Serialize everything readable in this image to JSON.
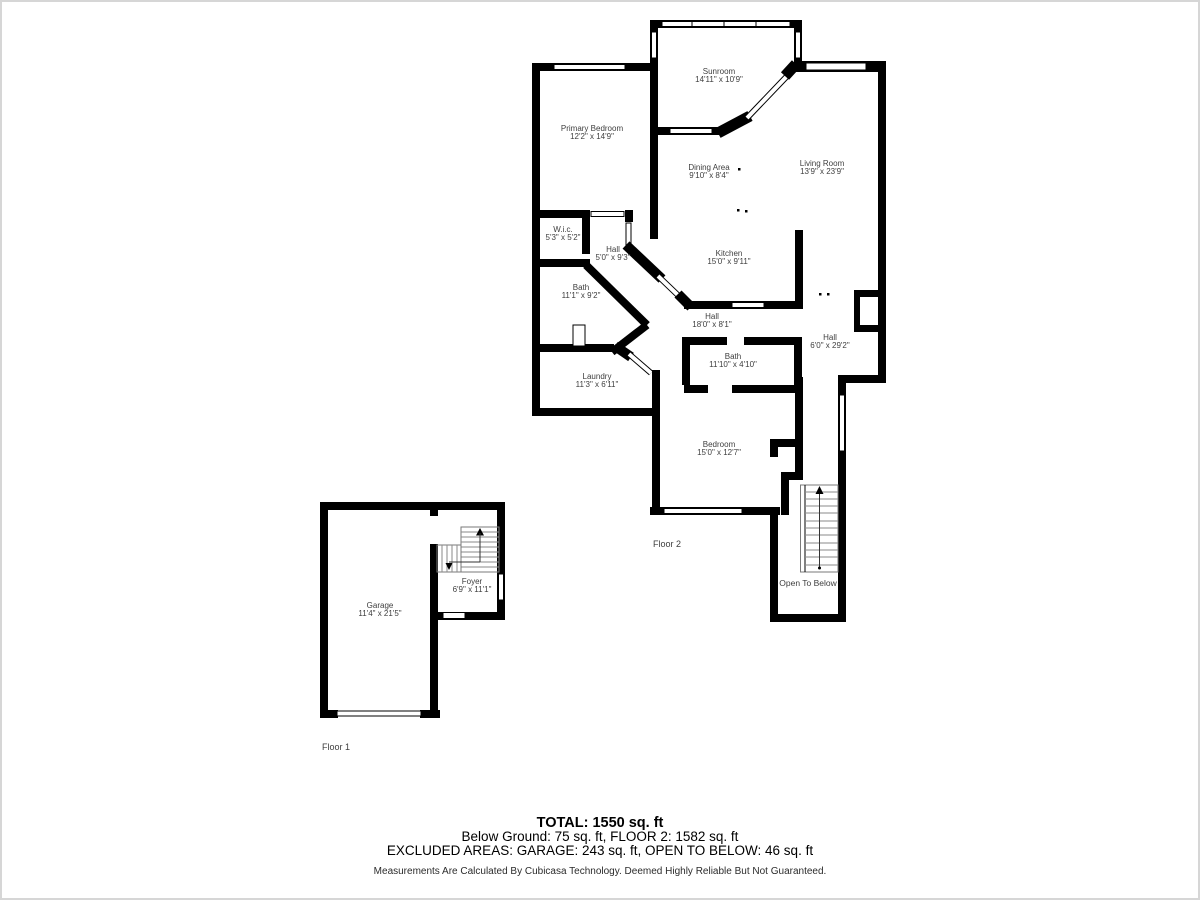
{
  "page": {
    "background": "#ffffff",
    "border_color": "#d6d6d6",
    "wall_color": "#000000"
  },
  "floor2": {
    "label": "Floor 2",
    "rooms": {
      "sunroom": {
        "name": "Sunroom",
        "dims": "14'11\" x 10'9\""
      },
      "primary_bedroom": {
        "name": "Primary Bedroom",
        "dims": "12'2\" x 14'9\""
      },
      "dining_area": {
        "name": "Dining Area",
        "dims": "9'10\" x 8'4\""
      },
      "living_room": {
        "name": "Living Room",
        "dims": "13'9\" x 23'9\""
      },
      "wic": {
        "name": "W.i.c.",
        "dims": "5'3\" x 5'2\""
      },
      "hall_small": {
        "name": "Hall",
        "dims": "5'0\" x 9'3\""
      },
      "kitchen": {
        "name": "Kitchen",
        "dims": "15'0\" x 9'11\""
      },
      "bath_main": {
        "name": "Bath",
        "dims": "11'1\" x 9'2\""
      },
      "hall_center": {
        "name": "Hall",
        "dims": "18'0\" x 8'1\""
      },
      "hall_right": {
        "name": "Hall",
        "dims": "6'0\" x 29'2\""
      },
      "bath_small": {
        "name": "Bath",
        "dims": "11'10\" x 4'10\""
      },
      "laundry": {
        "name": "Laundry",
        "dims": "11'3\" x 6'11\""
      },
      "bedroom": {
        "name": "Bedroom",
        "dims": "15'0\" x 12'7\""
      },
      "open_to_below": {
        "name": "Open To Below"
      }
    }
  },
  "floor1": {
    "label": "Floor 1",
    "rooms": {
      "garage": {
        "name": "Garage",
        "dims": "11'4\" x 21'5\""
      },
      "foyer": {
        "name": "Foyer",
        "dims": "6'9\" x 11'1\""
      }
    }
  },
  "summary": {
    "total": "TOTAL: 1550 sq. ft",
    "floors": "Below Ground: 75 sq. ft, FLOOR 2: 1582 sq. ft",
    "excluded": "EXCLUDED AREAS: GARAGE: 243 sq. ft, OPEN TO BELOW: 46 sq. ft",
    "disclaimer": "Measurements Are Calculated By Cubicasa Technology. Deemed Highly Reliable But Not Guaranteed."
  }
}
